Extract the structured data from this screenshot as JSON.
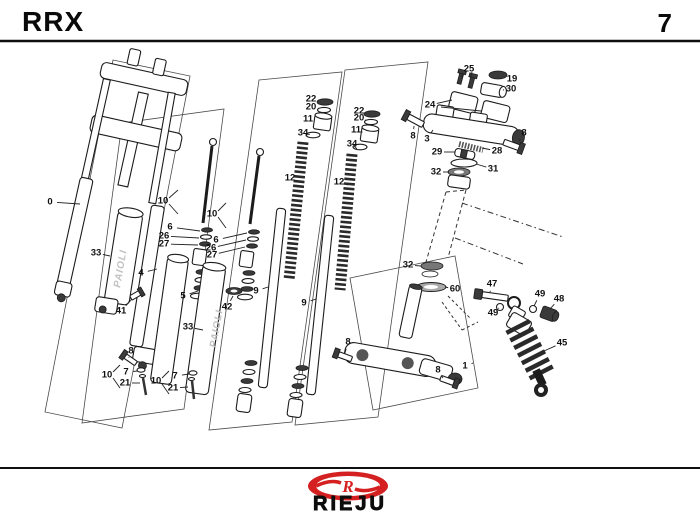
{
  "header": {
    "model": "RRX",
    "page": "7"
  },
  "footer": {
    "brand": "RIEJU",
    "logo_letter": "R"
  },
  "colors": {
    "accent_red": "#d42020",
    "line": "#1c1c1c"
  },
  "diagram": {
    "watermark": "PAIOLI",
    "callouts": [
      {
        "n": "0",
        "x": 50,
        "y": 202,
        "tx": 80,
        "ty": 204
      },
      {
        "n": "33",
        "x": 96,
        "y": 253,
        "tx": 110,
        "ty": 256
      },
      {
        "n": "4",
        "x": 141,
        "y": 273,
        "tx": 157,
        "ty": 269
      },
      {
        "n": "41",
        "x": 121,
        "y": 311,
        "tx": 132,
        "ty": 299
      },
      {
        "n": "5",
        "x": 183,
        "y": 296,
        "tx": 198,
        "ty": 291
      },
      {
        "n": "33",
        "x": 188,
        "y": 327,
        "tx": 203,
        "ty": 330
      },
      {
        "n": "42",
        "x": 227,
        "y": 307,
        "tx": 233,
        "ty": 296
      },
      {
        "n": "9",
        "x": 256,
        "y": 291,
        "tx": 268,
        "ty": 287
      },
      {
        "n": "9",
        "x": 304,
        "y": 303,
        "tx": 316,
        "ty": 299
      },
      {
        "n": "10",
        "x": 163,
        "y": 201
      },
      {
        "n": "6",
        "x": 170,
        "y": 227,
        "tx": 200,
        "ty": 231
      },
      {
        "n": "26",
        "x": 164,
        "y": 236,
        "tx": 199,
        "ty": 238
      },
      {
        "n": "27",
        "x": 164,
        "y": 244,
        "tx": 198,
        "ty": 245
      },
      {
        "n": "10",
        "x": 212,
        "y": 214
      },
      {
        "n": "6",
        "x": 216,
        "y": 240,
        "tx": 247,
        "ty": 233
      },
      {
        "n": "26",
        "x": 211,
        "y": 248,
        "tx": 246,
        "ty": 240
      },
      {
        "n": "27",
        "x": 212,
        "y": 255,
        "tx": 245,
        "ty": 247
      },
      {
        "n": "12",
        "x": 290,
        "y": 178,
        "tx": 298,
        "ty": 181
      },
      {
        "n": "12",
        "x": 339,
        "y": 182,
        "tx": 348,
        "ty": 185
      },
      {
        "n": "22",
        "x": 311,
        "y": 99,
        "tx": 318,
        "ty": 101
      },
      {
        "n": "20",
        "x": 311,
        "y": 107,
        "tx": 318,
        "ty": 109
      },
      {
        "n": "11",
        "x": 308,
        "y": 119,
        "tx": 315,
        "ty": 121
      },
      {
        "n": "34",
        "x": 303,
        "y": 133,
        "tx": 307,
        "ty": 134
      },
      {
        "n": "22",
        "x": 359,
        "y": 111,
        "tx": 365,
        "ty": 113
      },
      {
        "n": "20",
        "x": 359,
        "y": 118,
        "tx": 365,
        "ty": 120
      },
      {
        "n": "11",
        "x": 356,
        "y": 130,
        "tx": 362,
        "ty": 132
      },
      {
        "n": "34",
        "x": 352,
        "y": 144,
        "tx": 354,
        "ty": 146
      },
      {
        "n": "25",
        "x": 469,
        "y": 69,
        "tx": 461,
        "ty": 77
      },
      {
        "n": "19",
        "x": 512,
        "y": 79,
        "tx": 505,
        "ty": 77
      },
      {
        "n": "30",
        "x": 511,
        "y": 89,
        "tx": 503,
        "ty": 90
      },
      {
        "n": "24",
        "x": 430,
        "y": 105,
        "tx": 452,
        "ty": 100
      },
      {
        "n": "8",
        "x": 413,
        "y": 136,
        "tx": 414,
        "ty": 126
      },
      {
        "n": "3",
        "x": 427,
        "y": 139,
        "tx": 433,
        "ty": 130
      },
      {
        "n": "8",
        "x": 524,
        "y": 133,
        "tx": 519,
        "ty": 141
      },
      {
        "n": "29",
        "x": 437,
        "y": 152,
        "tx": 455,
        "ty": 152
      },
      {
        "n": "28",
        "x": 497,
        "y": 151,
        "tx": 482,
        "ty": 148
      },
      {
        "n": "31",
        "x": 493,
        "y": 169,
        "tx": 476,
        "ty": 164
      },
      {
        "n": "32",
        "x": 436,
        "y": 172,
        "tx": 449,
        "ty": 172
      },
      {
        "n": "32",
        "x": 408,
        "y": 265,
        "tx": 421,
        "ty": 266
      },
      {
        "n": "60",
        "x": 455,
        "y": 289,
        "tx": 445,
        "ty": 287
      },
      {
        "n": "47",
        "x": 492,
        "y": 284,
        "tx": 490,
        "ty": 292
      },
      {
        "n": "49",
        "x": 493,
        "y": 313,
        "tx": 499,
        "ty": 308
      },
      {
        "n": "49",
        "x": 540,
        "y": 294,
        "tx": 534,
        "ty": 306
      },
      {
        "n": "48",
        "x": 559,
        "y": 299,
        "tx": 550,
        "ty": 309
      },
      {
        "n": "45",
        "x": 562,
        "y": 343,
        "tx": 544,
        "ty": 351
      },
      {
        "n": "1",
        "x": 465,
        "y": 366,
        "tx": 473,
        "ty": 363
      },
      {
        "n": "8",
        "x": 348,
        "y": 342,
        "tx": 345,
        "ty": 353
      },
      {
        "n": "8",
        "x": 438,
        "y": 370,
        "tx": 443,
        "ty": 378
      },
      {
        "n": "8",
        "x": 131,
        "y": 351,
        "tx": 129,
        "ty": 357
      },
      {
        "n": "10",
        "x": 107,
        "y": 375
      },
      {
        "n": "7",
        "x": 126,
        "y": 372,
        "tx": 138,
        "ty": 371
      },
      {
        "n": "21",
        "x": 125,
        "y": 383,
        "tx": 140,
        "ty": 383
      },
      {
        "n": "10",
        "x": 156,
        "y": 381
      },
      {
        "n": "7",
        "x": 175,
        "y": 376,
        "tx": 189,
        "ty": 374
      },
      {
        "n": "21",
        "x": 173,
        "y": 388,
        "tx": 188,
        "ty": 387
      }
    ]
  }
}
